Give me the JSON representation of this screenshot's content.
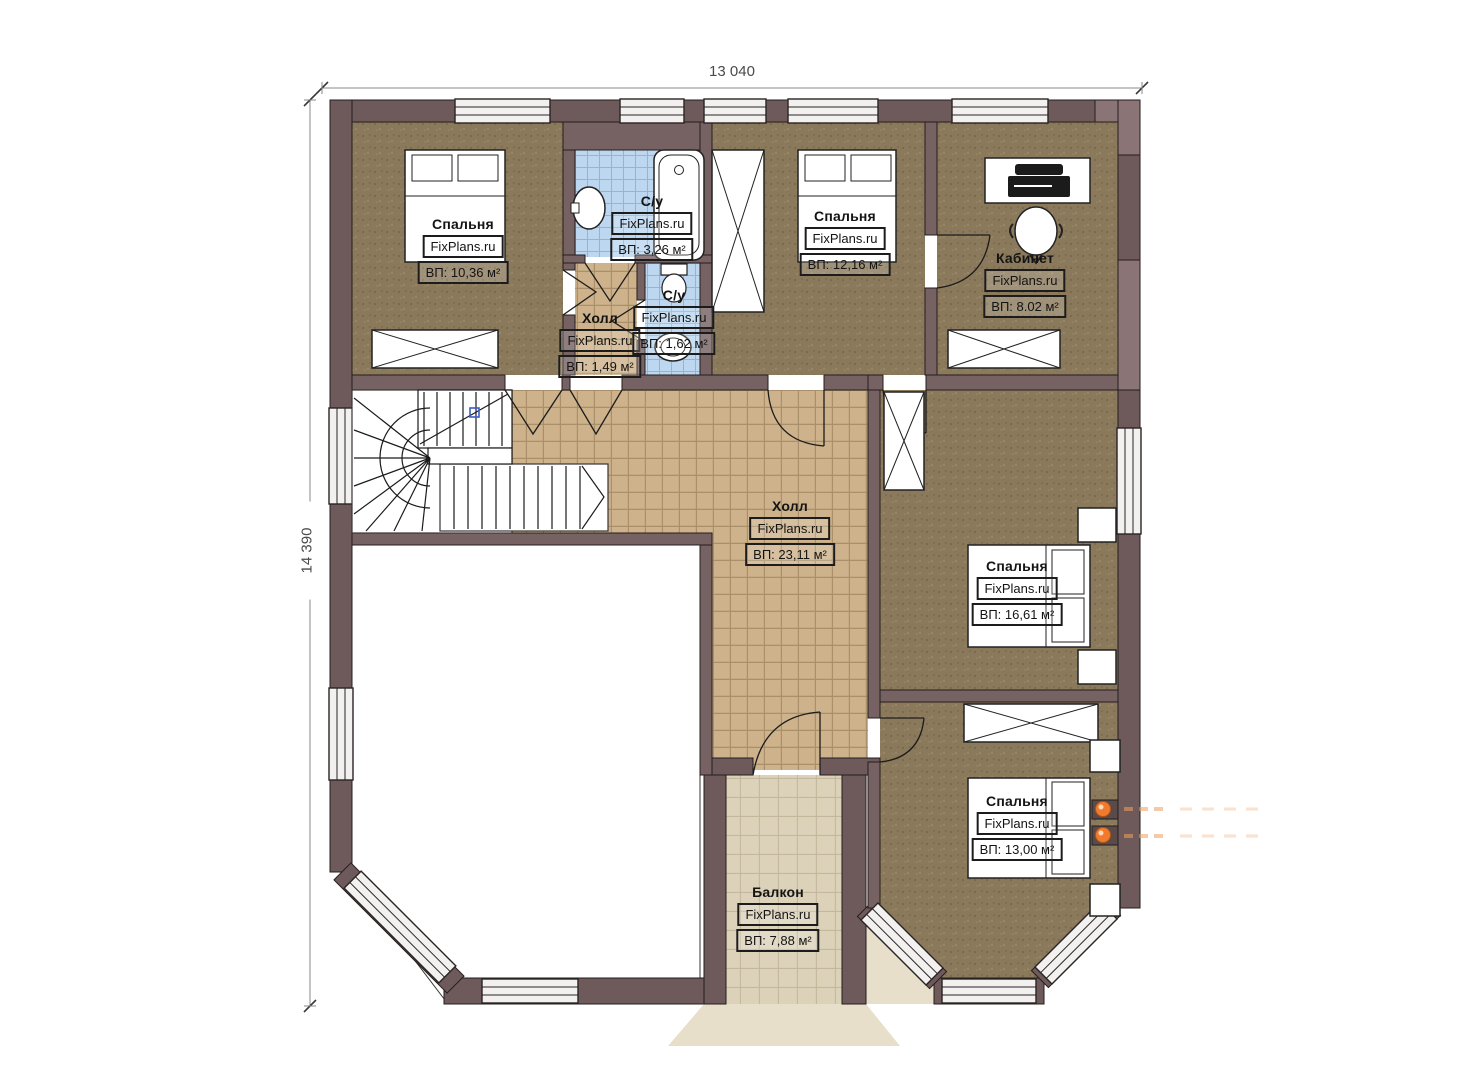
{
  "plan": {
    "type": "floor-plan",
    "watermark_site": "FixPlans.ru",
    "dimensions": {
      "width_label": "13 040",
      "height_label": "14 390"
    },
    "rooms": [
      {
        "id": "bedroom-1",
        "name": "Спальня",
        "watermark": "FixPlans.ru",
        "area": "ВП: 10,36 м²"
      },
      {
        "id": "bathroom-1",
        "name": "С/у",
        "watermark": "FixPlans.ru",
        "area": "ВП: 3,26 м²"
      },
      {
        "id": "hall-small",
        "name": "Холл",
        "watermark": "FixPlans.ru",
        "area": "ВП: 1,49 м²"
      },
      {
        "id": "bathroom-2",
        "name": "С/у",
        "watermark": "FixPlans.ru",
        "area": "ВП: 1,62 м²"
      },
      {
        "id": "bedroom-2",
        "name": "Спальня",
        "watermark": "FixPlans.ru",
        "area": "ВП: 12,16 м²"
      },
      {
        "id": "office",
        "name": "Кабинет",
        "watermark": "FixPlans.ru",
        "area": "ВП: 8.02 м²"
      },
      {
        "id": "hall-main",
        "name": "Холл",
        "watermark": "FixPlans.ru",
        "area": "ВП: 23,11 м²"
      },
      {
        "id": "bedroom-3",
        "name": "Спальня",
        "watermark": "FixPlans.ru",
        "area": "ВП: 16,61 м²"
      },
      {
        "id": "bedroom-4",
        "name": "Спальня",
        "watermark": "FixPlans.ru",
        "area": "ВП: 13,00 м²"
      },
      {
        "id": "balcony",
        "name": "Балкон",
        "watermark": "FixPlans.ru",
        "area": "ВП: 7,88 м²"
      }
    ],
    "colors": {
      "wall_outer": "#6e5a5b",
      "wall_inner": "#776263",
      "wall_light_patch": "#8b7475",
      "carpet": "#8b795c",
      "hall_tile": "#cdb28b",
      "bath_tile": "#bcd7ef",
      "balcony_floor": "#dcd2ba",
      "apron": "#e8dfca",
      "window_fill": "#f2f1ef",
      "radiator_orange": "#f07a2e",
      "section_marker_blue": "#3a5bc7"
    }
  }
}
